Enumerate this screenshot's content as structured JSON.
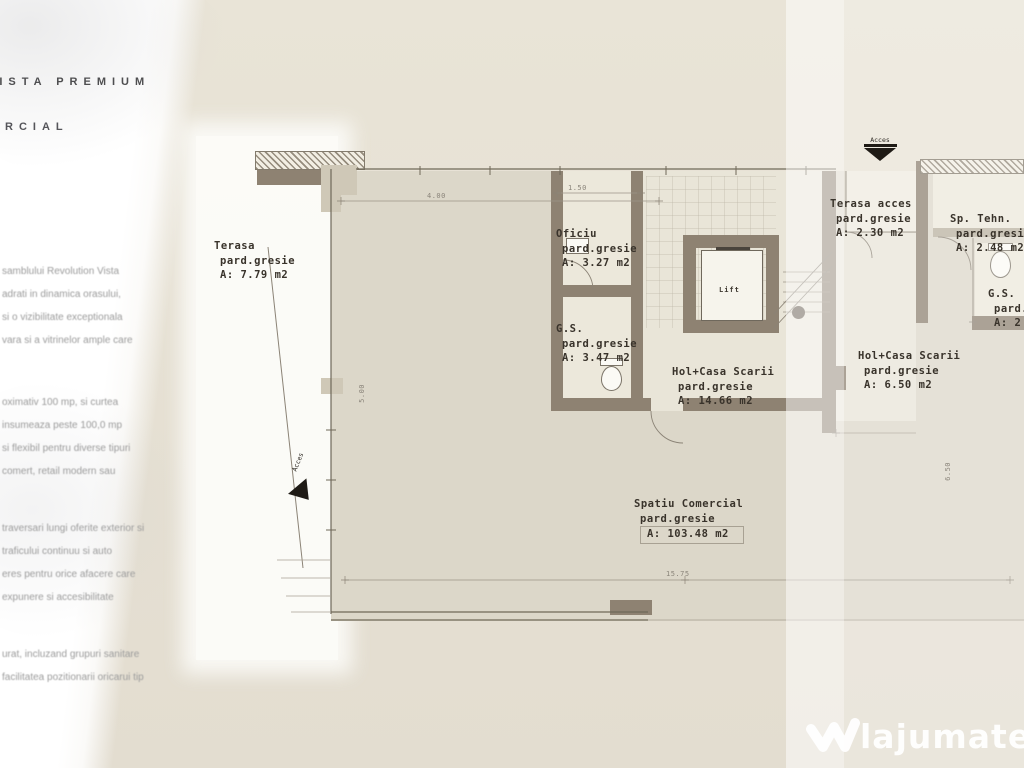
{
  "brand": {
    "title": "VISTA PREMIUM",
    "subtitle": "COMERCIAL"
  },
  "sidebar": {
    "paragraphs": [
      [
        "samblului Revolution Vista",
        "adrati in dinamica orasului,",
        "si o vizibilitate exceptionala",
        "vara si a vitrinelor ample care"
      ],
      [
        "oximativ 100 mp, si curtea",
        "insumeaza peste 100,0 mp",
        "si flexibil pentru diverse tipuri",
        "comert, retail modern sau"
      ],
      [
        "traversari lungi oferite exterior si",
        "traficului continuu si auto",
        "eres pentru orice afacere care",
        "expunere si accesibilitate"
      ],
      [
        "urat, incluzand grupuri sanitare",
        "facilitatea pozitionarii oricarui tip"
      ]
    ]
  },
  "plan": {
    "rooms": [
      {
        "name": "Terasa",
        "floor": "pard.gresie",
        "area": "A: 7.79 m2"
      },
      {
        "name": "Oficiu",
        "floor": "pard.gresie",
        "area": "A: 3.27 m2"
      },
      {
        "name": "G.S.",
        "floor": "pard.gresie",
        "area": "A: 3.47 m2"
      },
      {
        "name": "Hol+Casa Scarii",
        "floor": "pard.gresie",
        "area": "A: 14.66 m2"
      },
      {
        "name": "Terasa acces",
        "floor": "pard.gresie",
        "area": "A: 2.30 m2"
      },
      {
        "name": "Sp. Tehn.",
        "floor": "pard.gresie",
        "area": "A: 2.48 m2"
      },
      {
        "name": "G.S.",
        "floor": "pard.gresie",
        "area": "A: 2"
      },
      {
        "name": "Hol+Casa Scarii",
        "floor": "pard.gresie",
        "area": "A: 6.50 m2"
      },
      {
        "name": "Spatiu Comercial",
        "floor": "pard.gresie",
        "area": "A: 103.48 m2"
      }
    ],
    "lift_label": "Lift",
    "access_top": "Acces",
    "access_left": "Acces",
    "dimensions": [
      "4.00",
      "1.50",
      "5.00",
      "15.75",
      "6.50"
    ],
    "colors": {
      "wall": "#8e8272",
      "floor": "#dcd7c9",
      "label_text": "#39332b"
    }
  },
  "watermark": {
    "brand": "lajumate",
    "tld": ".ro"
  }
}
